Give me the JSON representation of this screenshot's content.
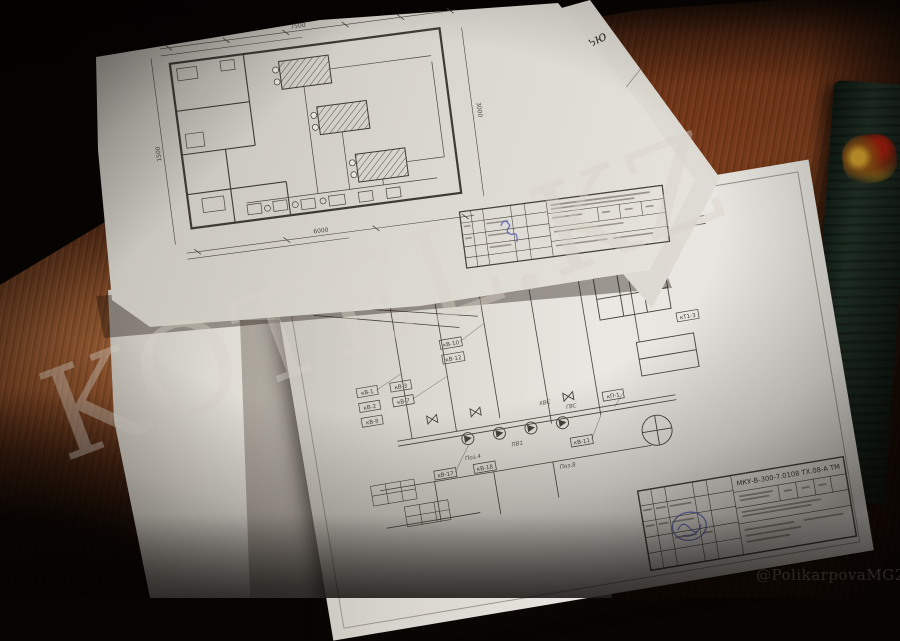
{
  "watermark": {
    "text": "KOTEL.KZ"
  },
  "credit": {
    "handle": "@PolikarpovaMG2020"
  },
  "upper_sheet": {
    "edge_fragments": {
      "line1": "щностью",
      "line2": "танция",
      "line3": "нического",
      "line4": "ние"
    },
    "plan_dims": {
      "top": "7500",
      "bottom": "6000",
      "left": "1500",
      "right": "3000"
    }
  },
  "lower_sheet": {
    "title_block": {
      "code": "МКУ-В-300-7.0108 ТХ.08-А ТМ"
    },
    "tags": [
      "кВ-1",
      "кВ-2",
      "кВ-3",
      "кВ-7",
      "кВ-8",
      "кВ-10",
      "кВ-12",
      "кЖ-2",
      "кВ-14",
      "уТ1-1",
      "кТ1-2",
      "кТ1-3",
      "кП-1",
      "кВ-17",
      "кВ-18",
      "кВ-11"
    ],
    "pipe_labels": {
      "l0": "ХВС",
      "l1": "ГВС",
      "l2": "ПВ1",
      "l3": "Поз.4",
      "l4": "Поз.8"
    }
  },
  "colors": {
    "table_wood": "#5d2e15",
    "paper": "#e4e2db",
    "stamp_blue": "#4a55b5",
    "book_green": "#1d2c22",
    "ink": "#45413b"
  }
}
